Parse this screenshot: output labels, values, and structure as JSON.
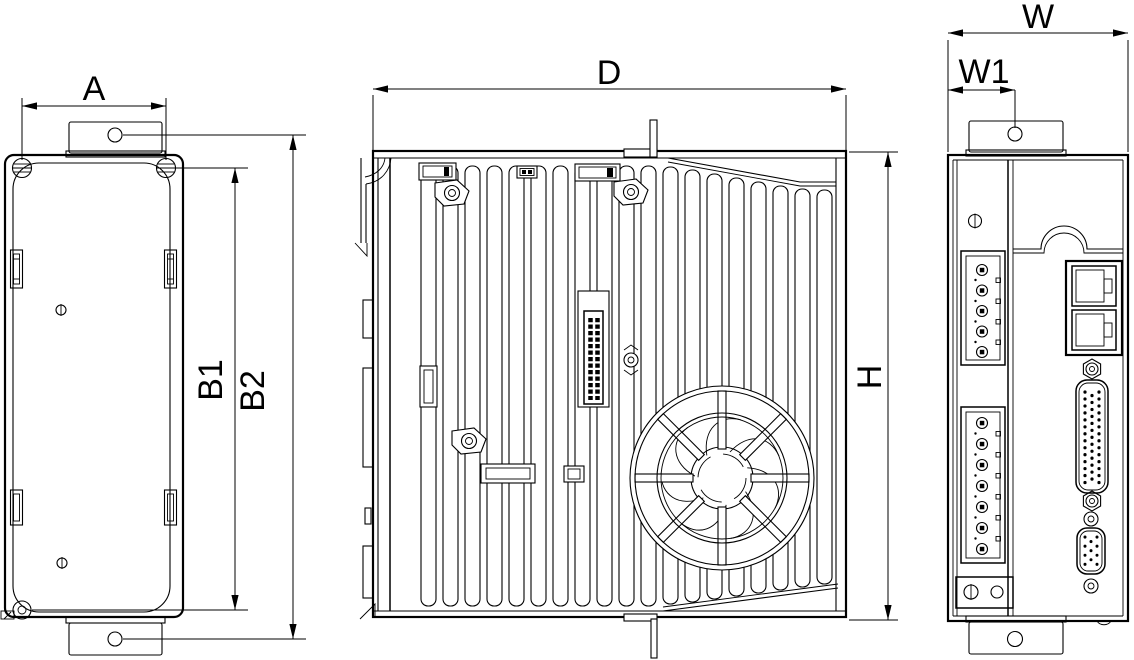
{
  "drawing": {
    "background_color": "#ffffff",
    "line_color": "#000000",
    "dimensions": {
      "A": "A",
      "B1": "B1",
      "B2": "B2",
      "D": "D",
      "H": "H",
      "W": "W",
      "W1": "W1"
    }
  }
}
